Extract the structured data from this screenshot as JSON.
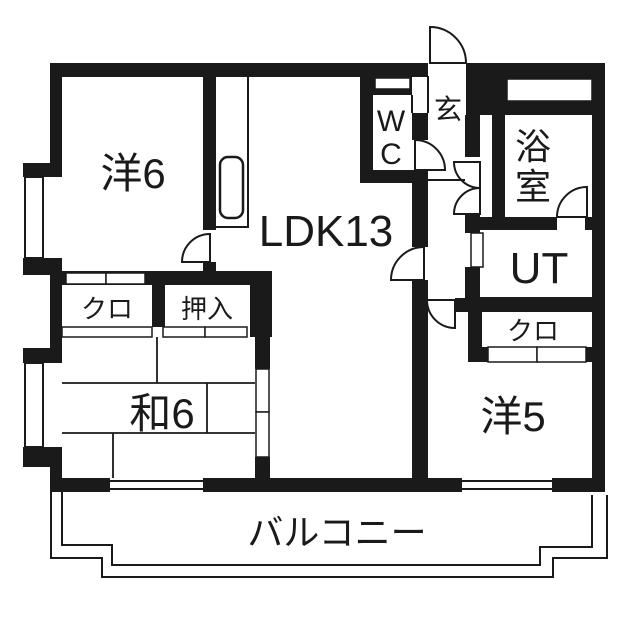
{
  "floorplan": {
    "wall_color": "#1a1a1a",
    "background_color": "#ffffff",
    "labels": {
      "yo6": "洋6",
      "ldk": "LDK13",
      "wc_line1": "W",
      "wc_line2": "C",
      "genkan": "玄",
      "bath_line1": "浴",
      "bath_line2": "室",
      "ut": "UT",
      "closet_left": "クロ",
      "oshiire": "押入",
      "wa6": "和6",
      "closet_right": "クロ",
      "yo5": "洋5",
      "balcony": "バルコニー"
    }
  }
}
